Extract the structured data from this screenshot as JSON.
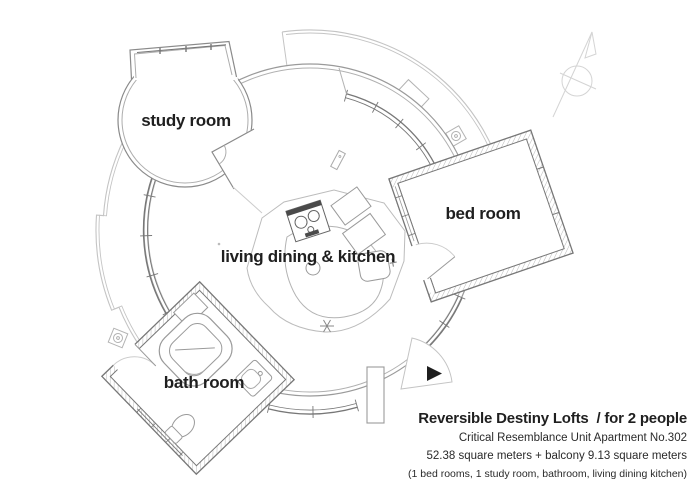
{
  "rooms": {
    "study": {
      "label": "study room"
    },
    "living": {
      "label": "living dining & kitchen"
    },
    "bed": {
      "label": "bed room"
    },
    "bath": {
      "label": "bath room"
    }
  },
  "title_block": {
    "title": "Reversible Destiny Lofts  / for 2 people",
    "unit": "Critical Resemblance Unit Apartment No.302",
    "area": "52.38 square meters + balcony 9.13 square meters",
    "rooms_list": "(1 bed rooms, 1 study room, bathroom, living dining kitchen)"
  },
  "icons": {
    "north_arrow": "north-compass-arrow",
    "entrance_marker": "entrance-direction-triangle",
    "drain": "balcony-floor-drain"
  },
  "colors": {
    "background": "#ffffff",
    "wall_line": "#777777",
    "mid_line": "#9a9a9a",
    "light_line": "#c4c4c4",
    "hatch": "#b8b8b8",
    "text": "#1f1f1f",
    "entrance_marker": "#1e1e1e"
  }
}
